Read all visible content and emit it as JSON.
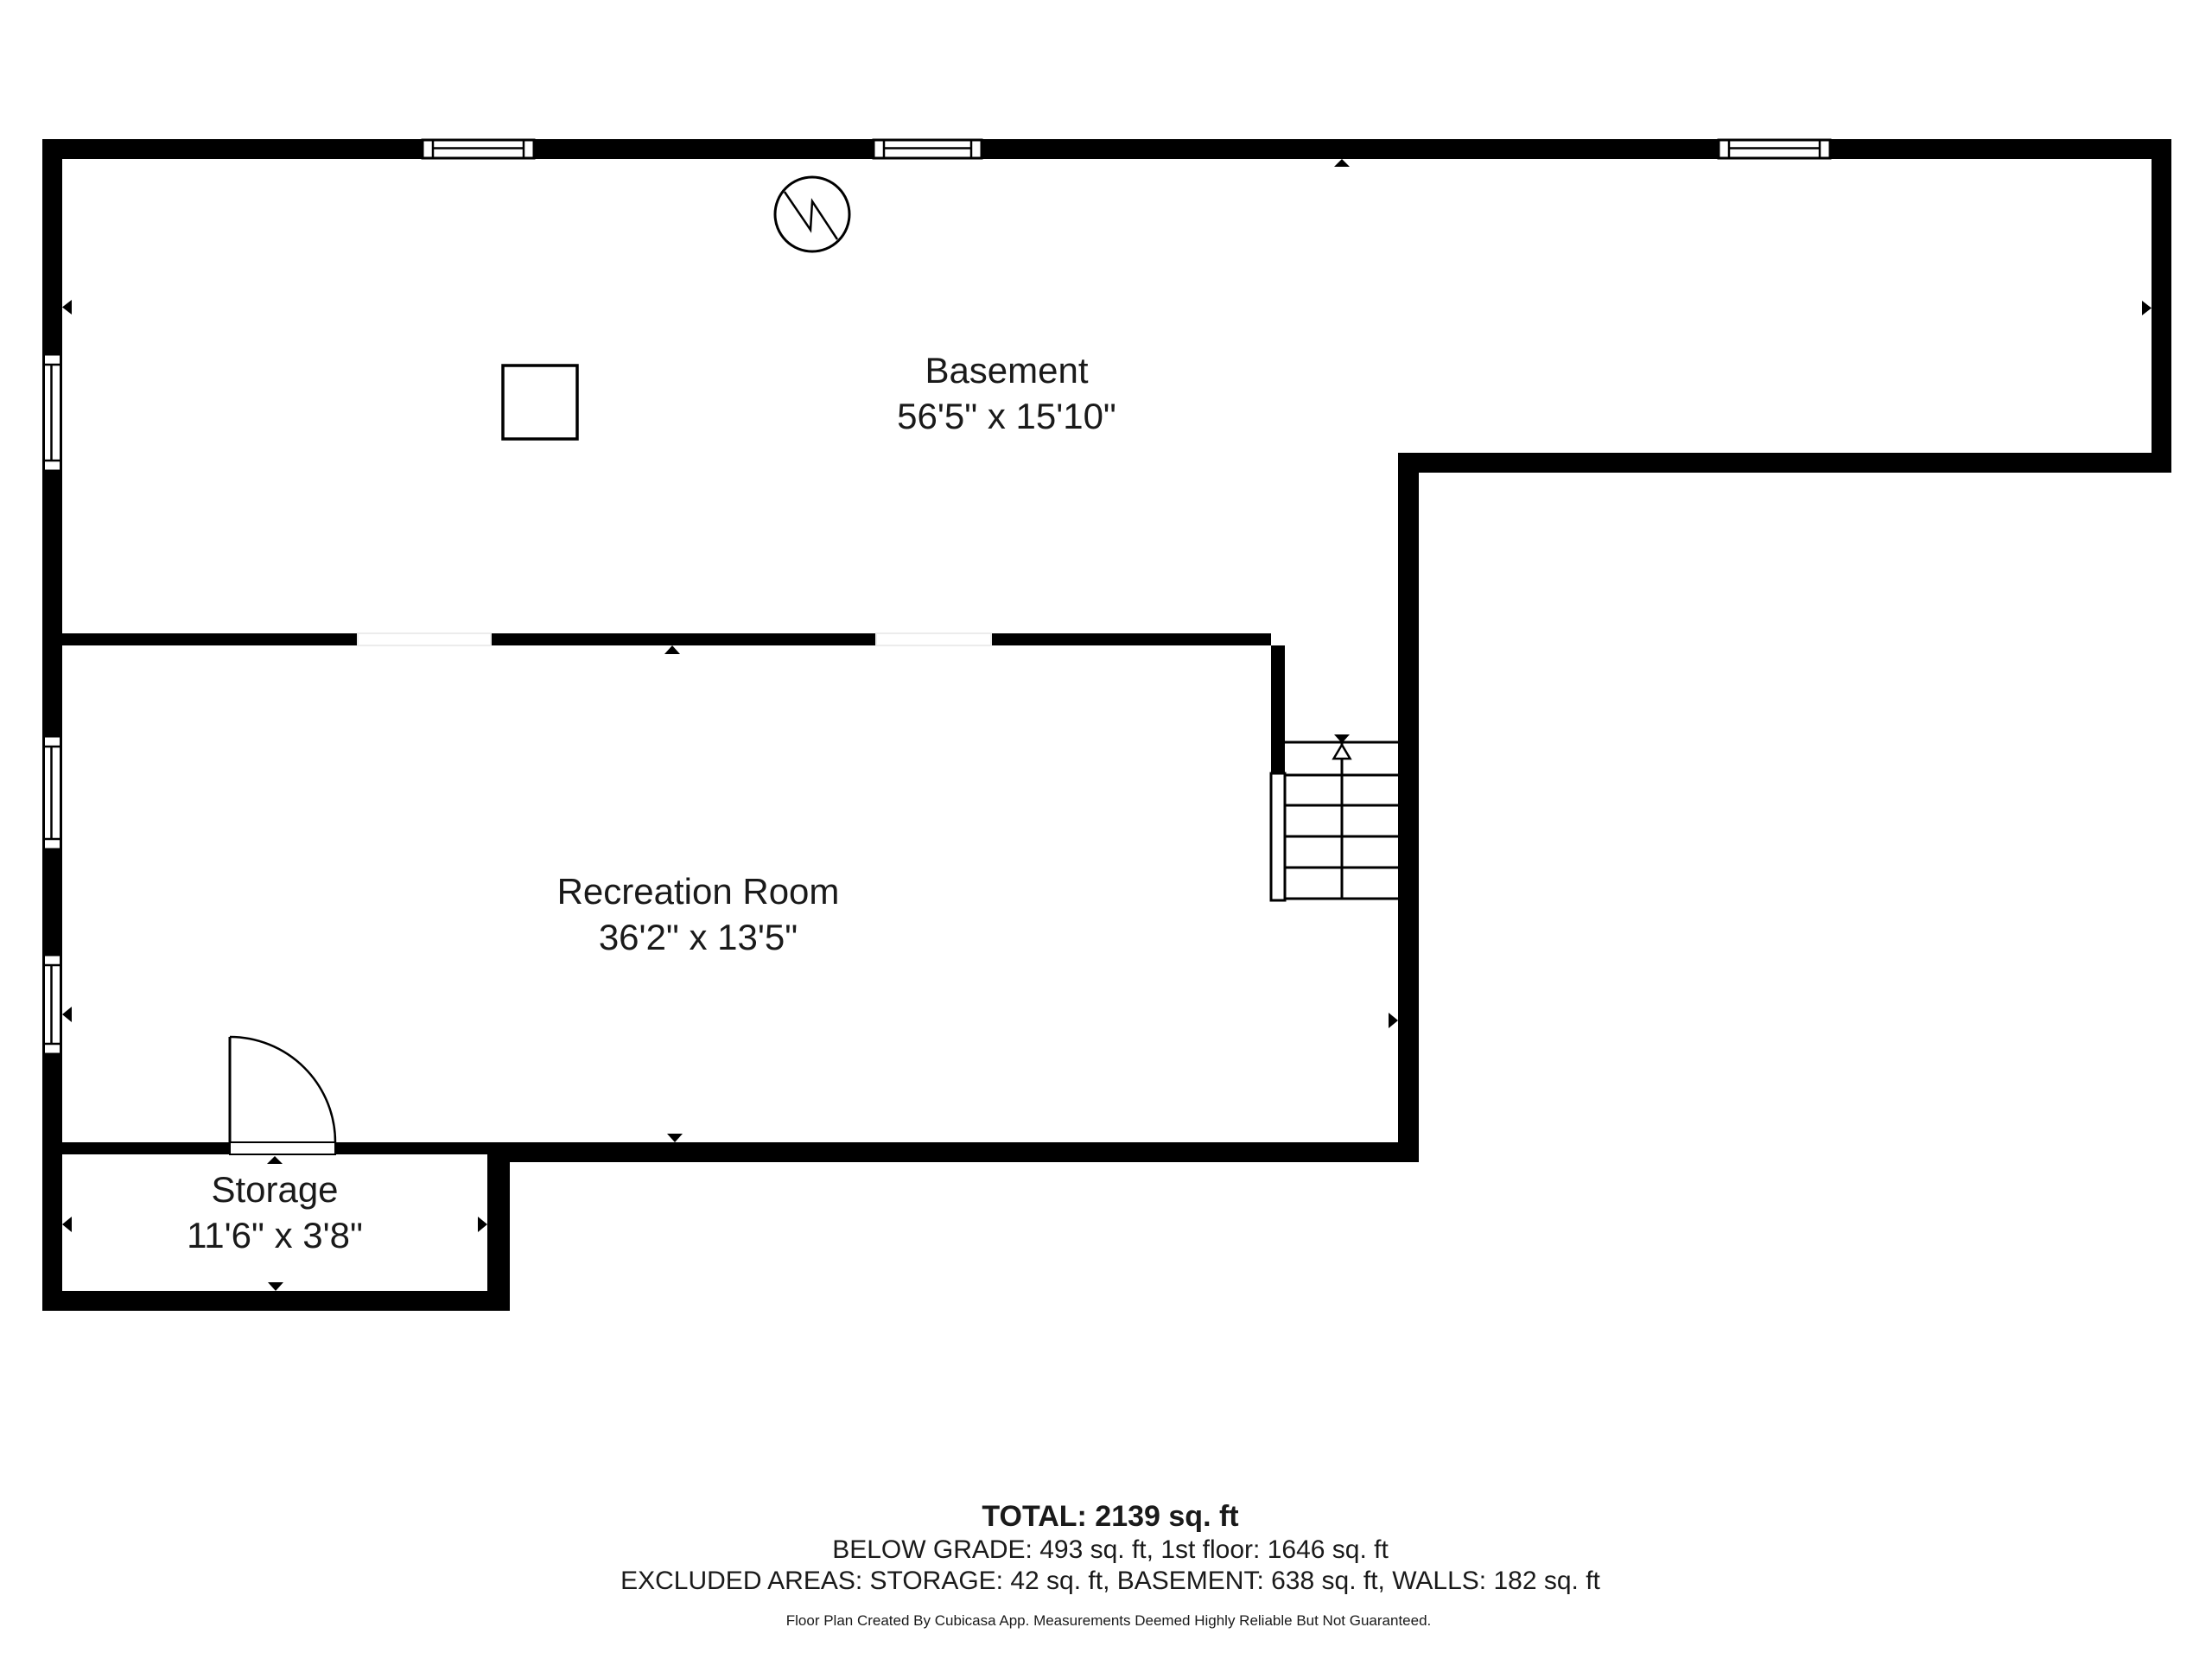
{
  "colors": {
    "wall": "#000000",
    "text": "#1a1a1a",
    "background": "#ffffff",
    "opening_stroke": "#ececec"
  },
  "rooms": [
    {
      "id": "basement",
      "name": "Basement",
      "dimensions": "56'5\" x 15'10\""
    },
    {
      "id": "recreation-room",
      "name": "Recreation Room",
      "dimensions": "36'2\" x 13'5\""
    },
    {
      "id": "storage",
      "name": "Storage",
      "dimensions": "11'6\" x 3'8\""
    }
  ],
  "summary": {
    "total": "TOTAL: 2139 sq. ft",
    "below_grade": "BELOW GRADE: 493 sq. ft, 1st floor: 1646 sq. ft",
    "excluded": "EXCLUDED AREAS: STORAGE: 42 sq. ft, BASEMENT: 638 sq. ft, WALLS: 182 sq. ft"
  },
  "footer": "Floor Plan Created By Cubicasa App. Measurements Deemed Highly Reliable But Not Guaranteed.",
  "icons": {
    "circle_zigzag": "circle-zigzag-symbol",
    "column": "column-symbol",
    "stair_direction": "stair-direction-marker",
    "wall_extent_arrows": "extent-arrow"
  }
}
